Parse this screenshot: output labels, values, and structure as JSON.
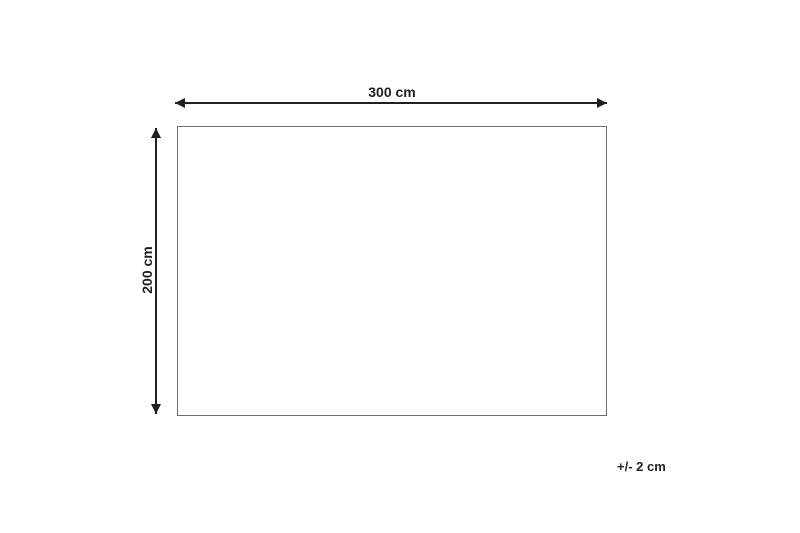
{
  "diagram": {
    "type": "dimension-diagram",
    "shape": "rectangle",
    "width_label": "300 cm",
    "height_label": "200 cm",
    "tolerance_label": "+/- 2 cm",
    "colors": {
      "line": "#231f20",
      "rect_border": "#6d6e71",
      "text": "#231f20",
      "background": "#ffffff"
    }
  }
}
